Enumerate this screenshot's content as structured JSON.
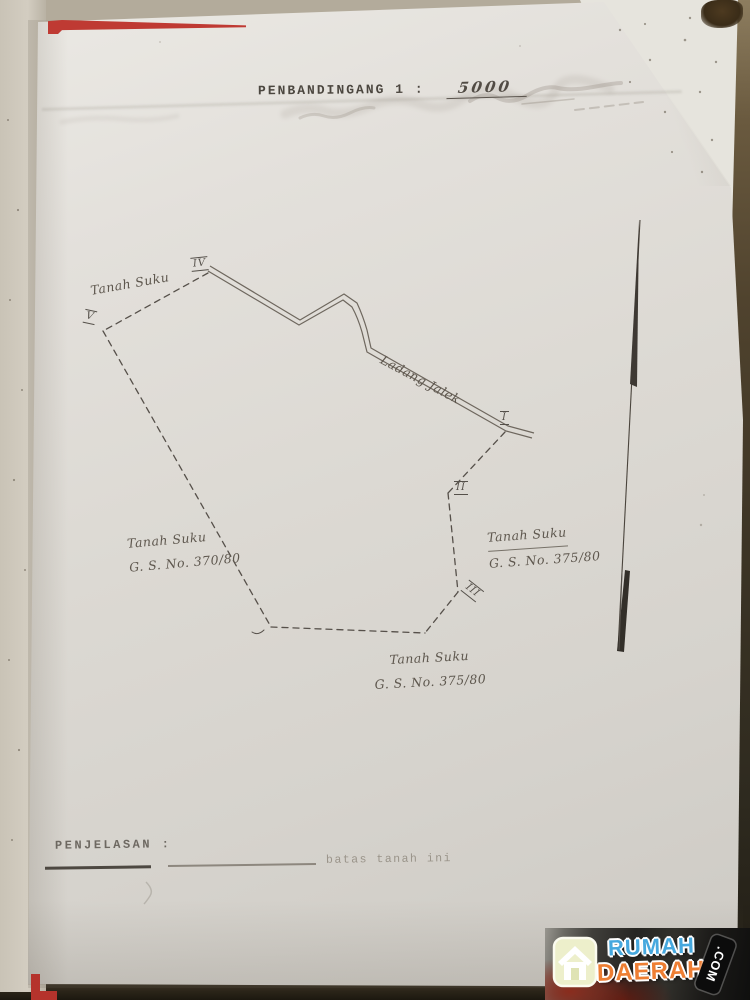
{
  "document": {
    "scale_heading": {
      "label": "PENBANDINGANG 1 :",
      "value": "5000"
    },
    "legend": {
      "heading": "PENJELASAN :",
      "boundary_label": "batas tanah ini"
    }
  },
  "map": {
    "area_labels": {
      "top_left": "Tanah Suku",
      "road": "Ladang Jalek",
      "left": {
        "line1": "Tanah Suku",
        "line2": "G. S. No. 370/80"
      },
      "right": {
        "line1": "Tanah Suku",
        "line2": "G. S. No. 375/80"
      },
      "bottom": {
        "line1": "Tanah Suku",
        "line2": "G. S. No. 375/80"
      }
    },
    "vertex_labels": {
      "i": "I",
      "ii": "II",
      "iii": "III",
      "iv": "IV",
      "v": "V"
    }
  },
  "watermark": {
    "word1": "RUMAH",
    "word2": "DAERAH",
    "tag": ".COM",
    "colors": {
      "word1": "#46a8de",
      "word2": "#ee7e33"
    }
  }
}
